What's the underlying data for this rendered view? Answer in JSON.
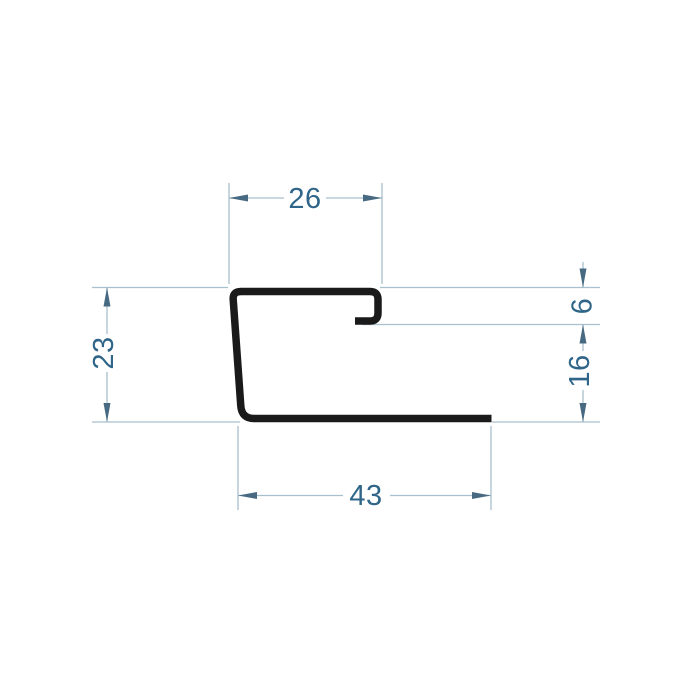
{
  "drawing": {
    "type": "technical-cross-section",
    "subject": "sheet-metal J-profile",
    "background": "#ffffff",
    "colors": {
      "profile": "#1a1a1a",
      "dimension_line": "#a9c0cd",
      "arrowhead": "#476a82",
      "dimension_text": "#2e6588"
    },
    "dimensions": {
      "top_width": "26",
      "left_height": "23",
      "right_upper_height": "6",
      "right_lower_height": "16",
      "bottom_width": "43"
    }
  }
}
